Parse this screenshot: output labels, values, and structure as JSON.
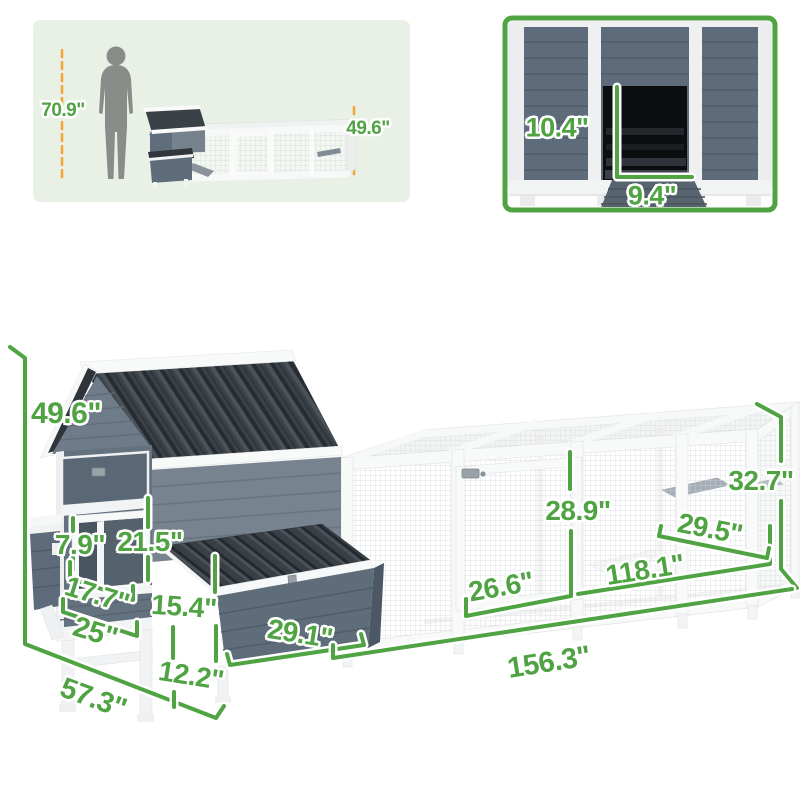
{
  "scale_panel": {
    "person_height": "70.9\"",
    "coop_height": "49.6\""
  },
  "detail_panel": {
    "pop_door_height": "10.4\"",
    "pop_door_width": "9.4\""
  },
  "main_dimensions": {
    "total_height": "49.6\"",
    "window_height": "7.9\"",
    "front_panel_height": "21.5\"",
    "window_width": "17.7\"",
    "house_width": "25\"",
    "nest_box_height": "15.4\"",
    "nest_box_width": "29.1\"",
    "ground_clearance": "12.2\"",
    "total_depth": "57.3\"",
    "run_door_width": "26.6\"",
    "run_door_height": "28.9\"",
    "run_length": "118.1\"",
    "run_depth": "29.5\"",
    "run_height": "32.7\"",
    "total_length": "156.3\""
  },
  "colors": {
    "dimension_green": "#4fa342",
    "scale_line_orange": "#f3a73b",
    "scale_panel_bg": "#e9f1e6",
    "label_outline": "#ffffff",
    "coop_wall_blue": "#64727f",
    "coop_roof_dark": "#3a4147",
    "frame_white": "#f8f9f9"
  }
}
